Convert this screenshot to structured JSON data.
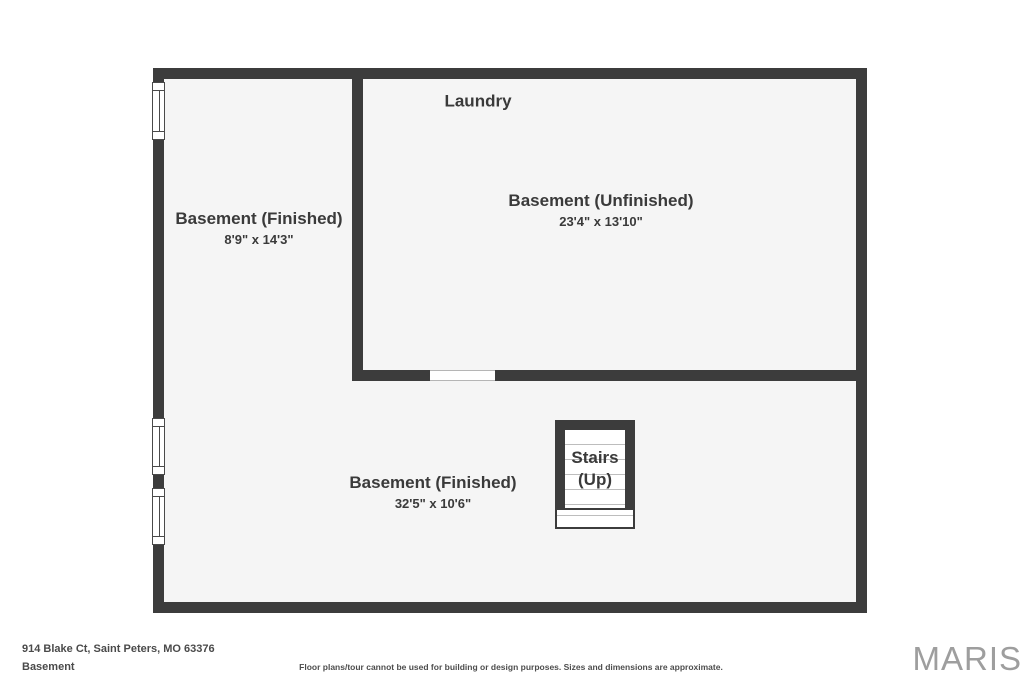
{
  "plan": {
    "laundry_label": "Laundry",
    "rooms": [
      {
        "name": "Basement (Finished)",
        "dims": "8'9\" x 14'3\""
      },
      {
        "name": "Basement (Unfinished)",
        "dims": "23'4\" x 13'10\""
      },
      {
        "name": "Basement (Finished)",
        "dims": "32'5\" x 10'6\""
      }
    ],
    "stairs": {
      "line1": "Stairs",
      "line2": "(Up)"
    }
  },
  "footer": {
    "address": "914 Blake Ct, Saint Peters, MO 63376",
    "level": "Basement",
    "disclaimer": "Floor plans/tour cannot be used for building or design purposes. Sizes and dimensions are approximate.",
    "brand": "MARIS"
  },
  "colors": {
    "wall": "#3c3c3c",
    "room_fill": "#f5f5f5",
    "label_text": "#3a3a3a",
    "brand_text": "#9e9e9e"
  }
}
